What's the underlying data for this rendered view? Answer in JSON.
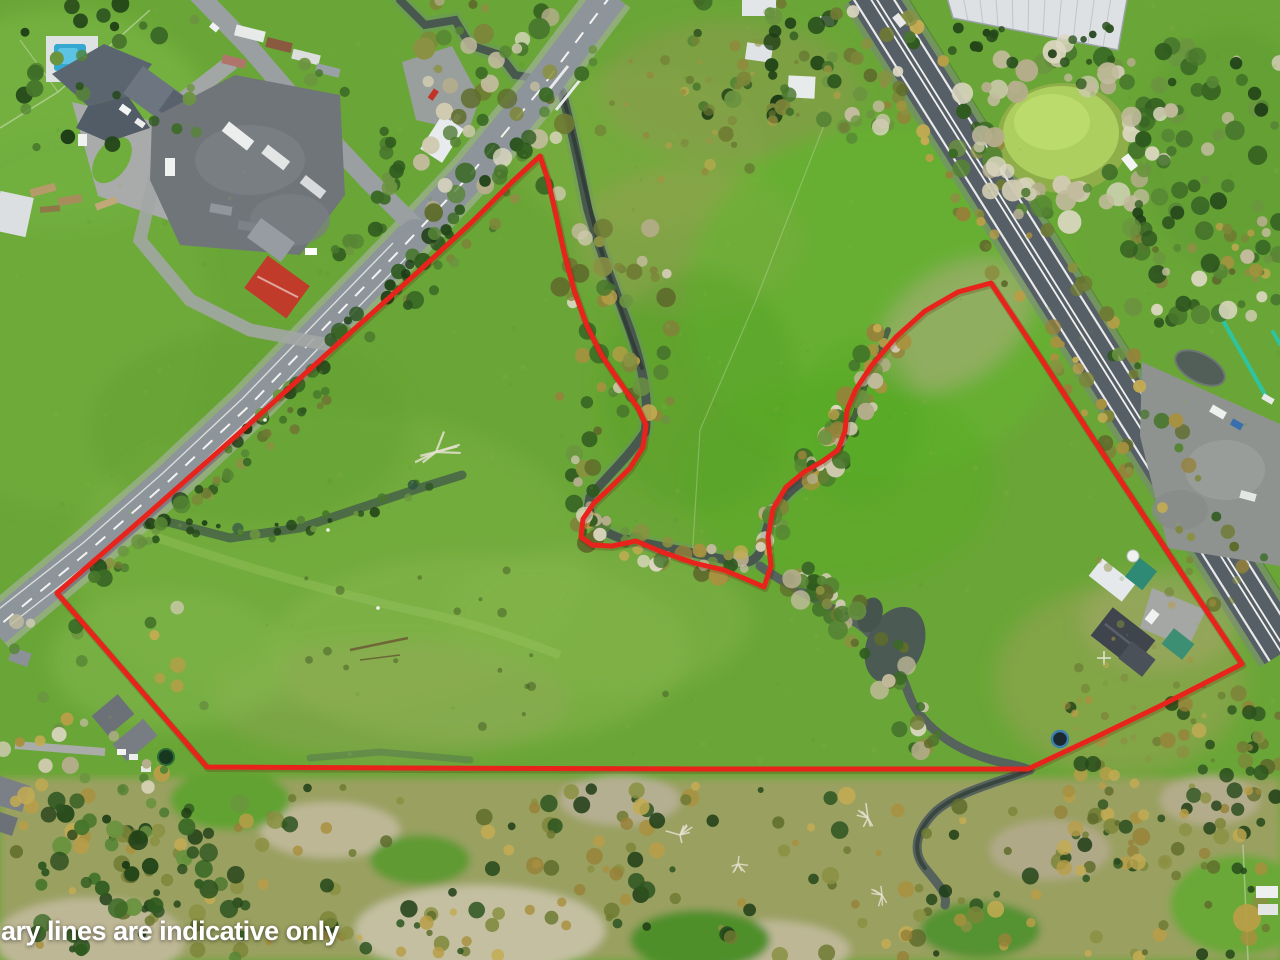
{
  "scene": {
    "description": "Aerial drone photo of a rural property: paddocks, a meandering tree-lined stream, a country road (upper left), a state highway (right), farm buildings and an industrial yard (top left), an algae pond (top right), scrub along the bottom, with a red site-boundary overlay.",
    "caption": "ary lines are indicative only"
  },
  "boundary": {
    "color": "#e8231c"
  },
  "colors": {
    "pasture": "#6aa637",
    "bright_pasture": "#5fb32a",
    "dry_grass": "#b7b295",
    "stream_water": "#49584f",
    "algae_pond": "#accf5f",
    "country_road": "#8d959b",
    "highway": "#565e66",
    "red_roof_building": "#c13b2b",
    "swimming_pool": "#35a8d0",
    "caption_text": "#ffffff"
  }
}
